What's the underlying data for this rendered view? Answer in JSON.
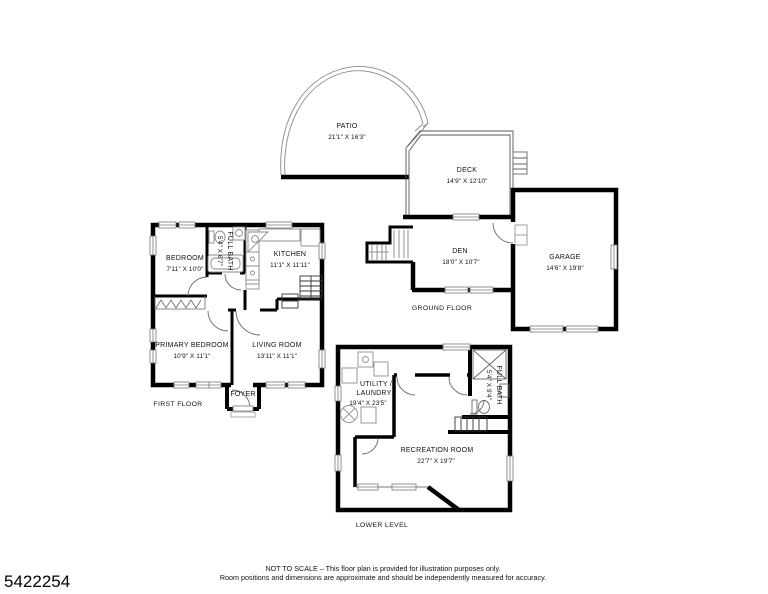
{
  "page": {
    "background": "#ffffff",
    "wall_color": "#000000",
    "thin_line_color": "#777777",
    "text_color": "#111111"
  },
  "listing_number": "5422254",
  "floor_plan": {
    "ground_floor": {
      "label": "GROUND FLOOR",
      "rooms": {
        "patio": {
          "name": "PATIO",
          "dimensions": "21'1\" X 16'3\""
        },
        "deck": {
          "name": "DECK",
          "dimensions": "14'9\" X 12'10\""
        },
        "den": {
          "name": "DEN",
          "dimensions": "18'0\" X 10'7\""
        },
        "garage": {
          "name": "GARAGE",
          "dimensions": "14'6\" X 19'8\""
        }
      }
    },
    "first_floor": {
      "label": "FIRST FLOOR",
      "rooms": {
        "bedroom": {
          "name": "BEDROOM",
          "dimensions": "7'11\" X 10'0\""
        },
        "full_bath": {
          "name": "FULL BATH",
          "dimensions": "5'4\" X 6'7\""
        },
        "kitchen": {
          "name": "KITCHEN",
          "dimensions": "11'1\" X 11'11\""
        },
        "primary_bedroom": {
          "name": "PRIMARY BEDROOM",
          "dimensions": "10'9\" X 11'1\""
        },
        "living_room": {
          "name": "LIVING ROOM",
          "dimensions": "13'11\" X 11'1\""
        },
        "foyer": {
          "name": "FOYER"
        }
      }
    },
    "lower_level": {
      "label": "LOWER LEVEL",
      "rooms": {
        "utility_laundry": {
          "name_line1": "UTILITY /",
          "name_line2": "LAUNDRY",
          "dimensions": "19'4\" X 23'5\""
        },
        "full_bath": {
          "name": "FULL BATH",
          "dimensions": "5'4\" X 9'4\""
        },
        "recreation_room": {
          "name": "RECREATION ROOM",
          "dimensions": "22'7\" X 19'7\""
        }
      }
    }
  },
  "disclaimer": {
    "line1": "NOT TO SCALE – This floor plan is provided for illustration purposes only.",
    "line2": "Room positions and dimensions are approximate and should be independently measured for accuracy."
  }
}
